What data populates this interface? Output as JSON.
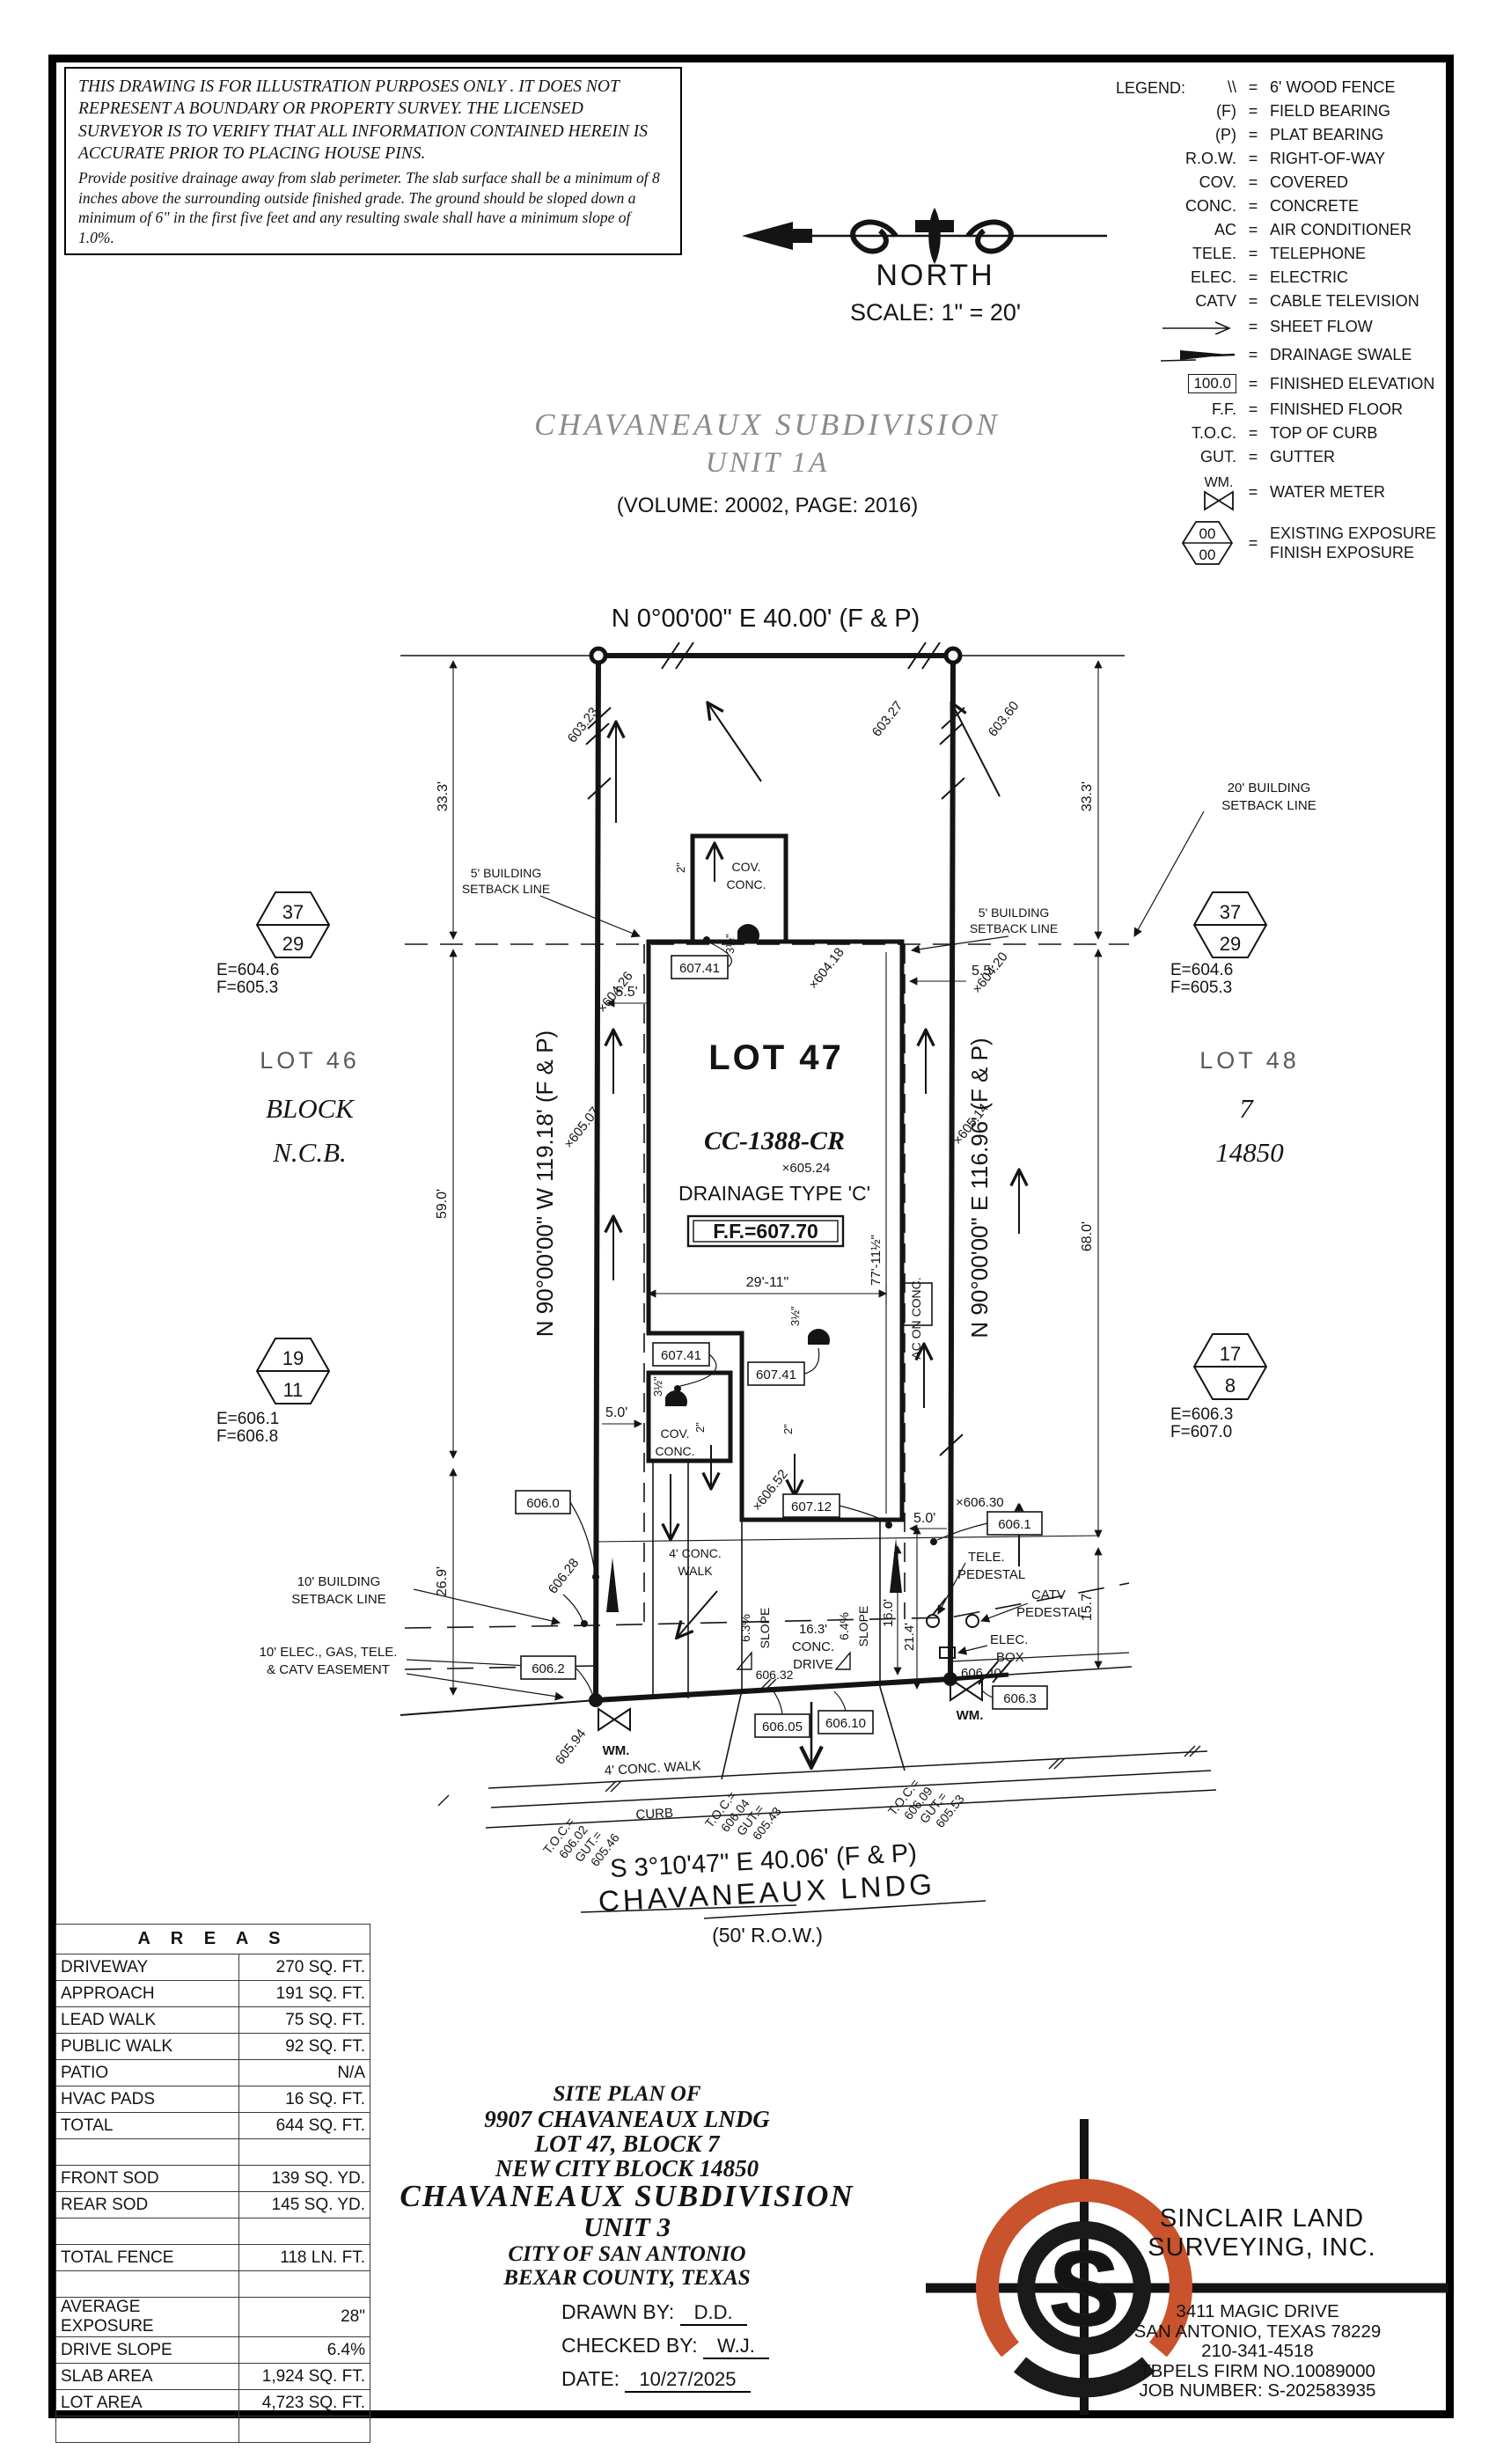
{
  "disclaimer": {
    "p1": "THIS DRAWING IS FOR ILLUSTRATION PURPOSES ONLY . IT DOES NOT REPRESENT A BOUNDARY OR PROPERTY SURVEY. THE LICENSED SURVEYOR IS TO VERIFY THAT ALL INFORMATION CONTAINED HEREIN IS ACCURATE PRIOR TO PLACING HOUSE PINS.",
    "p2": "Provide positive drainage away from slab perimeter. The slab surface shall be a minimum of 8 inches above the surrounding outside finished grade. The ground should be sloped down a minimum of 6\" in the first five feet and any resulting swale shall have a minimum slope of 1.0%."
  },
  "compass": {
    "north": "NORTH",
    "scale": "SCALE: 1\" = 20'"
  },
  "legend": {
    "title": "LEGEND:",
    "rows": [
      {
        "sym": "\\\\",
        "label": "6' WOOD FENCE"
      },
      {
        "sym": "(F)",
        "label": "FIELD BEARING"
      },
      {
        "sym": "(P)",
        "label": "PLAT BEARING"
      },
      {
        "sym": "R.O.W.",
        "label": "RIGHT-OF-WAY"
      },
      {
        "sym": "COV.",
        "label": "COVERED"
      },
      {
        "sym": "CONC.",
        "label": "CONCRETE"
      },
      {
        "sym": "AC",
        "label": "AIR CONDITIONER"
      },
      {
        "sym": "TELE.",
        "label": "TELEPHONE"
      },
      {
        "sym": "ELEC.",
        "label": "ELECTRIC"
      },
      {
        "sym": "CATV",
        "label": "CABLE TELEVISION"
      },
      {
        "sym": "",
        "label": "SHEET FLOW"
      },
      {
        "sym": "",
        "label": "DRAINAGE SWALE"
      },
      {
        "sym": "100.0",
        "label": "FINISHED ELEVATION"
      },
      {
        "sym": "F.F.",
        "label": "FINISHED FLOOR"
      },
      {
        "sym": "T.O.C.",
        "label": "TOP OF CURB"
      },
      {
        "sym": "GUT.",
        "label": "GUTTER"
      },
      {
        "sym": "WM.",
        "label": "WATER METER"
      },
      {
        "sym": "00",
        "sym2": "00",
        "label": "EXISTING EXPOSURE",
        "label2": "FINISH EXPOSURE"
      }
    ]
  },
  "subdivision": {
    "title": "CHAVANEAUX SUBDIVISION",
    "unit": "UNIT 1A",
    "volume": "(VOLUME: 20002, PAGE: 2016)"
  },
  "plat": {
    "bearing_top": "N 0°00'00\" E 40.00' (F & P)",
    "bearing_left": "N 90°00'00\" W 119.18' (F & P)",
    "bearing_right": "N 90°00'00\" E 116.96' (F & P)",
    "bearing_bottom": "S 3°10'47\" E 40.06' (F & P)",
    "street": {
      "name": "CHAVANEAUX LNDG",
      "row": "(50' R.O.W.)"
    },
    "lots": {
      "lot46": "LOT 46",
      "block_word": "BLOCK",
      "ncb_word": "N.C.B.",
      "lot47": "LOT 47",
      "lot48": "LOT 48",
      "block_num": "7",
      "ncb_num": "14850"
    },
    "house": {
      "cc": "CC-1388-CR",
      "spot": "×605.24",
      "drainage": "DRAINAGE  TYPE  'C'",
      "ff": "F.F.=607.70",
      "ac": "AC ON CONC.",
      "cov_top": [
        "COV.",
        "CONC."
      ],
      "cov_bottom": [
        "COV.",
        "CONC."
      ]
    },
    "hex": {
      "tl": {
        "a": "37",
        "b": "29",
        "e": "E=604.6",
        "f": "F=605.3"
      },
      "tr": {
        "a": "37",
        "b": "29",
        "e": "E=604.6",
        "f": "F=605.3"
      },
      "bl": {
        "a": "19",
        "b": "11",
        "e": "E=606.1",
        "f": "F=606.8"
      },
      "br": {
        "a": "17",
        "b": "8",
        "e": "E=606.3",
        "f": "F=607.0"
      }
    },
    "setbacks": {
      "s20": [
        "20' BUILDING",
        "SETBACK LINE"
      ],
      "s5l": [
        "5' BUILDING",
        "SETBACK LINE"
      ],
      "s5r": [
        "5' BUILDING",
        "SETBACK LINE"
      ],
      "s10": [
        "10' BUILDING",
        "SETBACK LINE"
      ],
      "easement": [
        "10' ELEC., GAS, TELE.",
        "& CATV EASEMENT"
      ]
    },
    "dims": {
      "d333l": "33.3'",
      "d333r": "33.3'",
      "d590": "59.0'",
      "d269": "26.9'",
      "d680": "68.0'",
      "d157": "15.7'",
      "d55l": "5.5'",
      "d55r": "5.5'",
      "d50l": "5.0'",
      "d50r": "5.0'",
      "d2911": "29'-11\"",
      "d7711": "77'-11½\"",
      "d160": "16.0'",
      "d214": "21.4'",
      "d35a": "3½\"",
      "d35b": "3½\"",
      "d35c": "3½\"",
      "d2a": "2\"",
      "d2b": "2\"",
      "d2c": "2\""
    },
    "boxed": {
      "b60741a": "607.41",
      "b60741b": "607.41",
      "b60741c": "607.41",
      "b60712": "607.12",
      "b6060": "606.0",
      "b6061": "606.1",
      "b6062": "606.2",
      "b6063": "606.3",
      "b60605": "606.05",
      "b60610": "606.10"
    },
    "spots": {
      "s60323": "603.23",
      "s60327": "603.27",
      "s60360": "603.60",
      "s60426": "×604.26",
      "s60418": "×604.18",
      "s60420": "×604.20",
      "s60507": "×605.07",
      "s60514": "×605.14",
      "s60652": "×606.52",
      "s60628": "606.28",
      "s60594": "605.94",
      "s60630": "×606.30",
      "s60640": "606.40",
      "s60632": "606.32"
    },
    "features": {
      "drive": [
        "16.3'",
        "CONC.",
        "DRIVE"
      ],
      "slope_l": [
        "6.3%",
        "SLOPE"
      ],
      "slope_r": [
        "6.4%",
        "SLOPE"
      ],
      "walk_mid": [
        "4' CONC.",
        "WALK"
      ],
      "walk_street": "4' CONC. WALK",
      "curb": "CURB",
      "tele": [
        "TELE.",
        "PEDESTAL"
      ],
      "catv": [
        "CATV",
        "PEDESTAL"
      ],
      "elec": [
        "ELEC.",
        "BOX"
      ],
      "wm_l": "WM.",
      "wm_r": "WM."
    },
    "toc": [
      [
        "T.O.C.=",
        "606.02",
        "GUT.=",
        "605.46"
      ],
      [
        "T.O.C.=",
        "606.04",
        "GUT.=",
        "605.43"
      ],
      [
        "T.O.C.=",
        "606.09",
        "GUT.=",
        "605.53"
      ]
    ]
  },
  "areas": {
    "title": "A R E A S",
    "rows": [
      {
        "label": "DRIVEWAY",
        "value": "270 SQ. FT."
      },
      {
        "label": "APPROACH",
        "value": "191 SQ. FT."
      },
      {
        "label": "LEAD WALK",
        "value": "75 SQ. FT."
      },
      {
        "label": "PUBLIC WALK",
        "value": "92 SQ. FT."
      },
      {
        "label": "PATIO",
        "value": "N/A"
      },
      {
        "label": "HVAC PADS",
        "value": "16 SQ. FT."
      },
      {
        "label": "TOTAL",
        "value": "644 SQ. FT."
      },
      {
        "label": "",
        "value": ""
      },
      {
        "label": "FRONT SOD",
        "value": "139 SQ. YD."
      },
      {
        "label": "REAR SOD",
        "value": "145 SQ. YD."
      },
      {
        "label": "",
        "value": ""
      },
      {
        "label": "TOTAL FENCE",
        "value": "118 LN. FT."
      },
      {
        "label": "",
        "value": ""
      },
      {
        "label": "AVERAGE EXPOSURE",
        "value": "28\""
      },
      {
        "label": "DRIVE SLOPE",
        "value": "6.4%"
      },
      {
        "label": "SLAB AREA",
        "value": "1,924 SQ. FT."
      },
      {
        "label": "LOT AREA",
        "value": "4,723 SQ. FT."
      },
      {
        "label": "",
        "value": ""
      }
    ]
  },
  "titleblock": {
    "l1": "SITE PLAN OF",
    "l2": "9907 CHAVANEAUX LNDG",
    "l3": "LOT 47, BLOCK 7",
    "l4": "NEW CITY BLOCK 14850",
    "l5": "CHAVANEAUX SUBDIVISION",
    "l6": "UNIT 3",
    "l7": "CITY OF SAN ANTONIO",
    "l8": "BEXAR COUNTY, TEXAS",
    "drawn_label": "DRAWN BY:",
    "drawn": "D.D.",
    "checked_label": "CHECKED BY:",
    "checked": "W.J.",
    "date_label": "DATE:",
    "date": "10/27/2025"
  },
  "firm": {
    "logo_letter": "S",
    "name1": "SINCLAIR LAND",
    "name2": "SURVEYING, INC.",
    "addr1": "3411 MAGIC DRIVE",
    "addr2": "SAN ANTONIO, TEXAS 78229",
    "phone": "210-341-4518",
    "firm_no": "TBPELS FIRM NO.10089000",
    "job": "JOB NUMBER: S-202583935"
  },
  "colors": {
    "accent": "#c8532c",
    "ink": "#141414"
  }
}
